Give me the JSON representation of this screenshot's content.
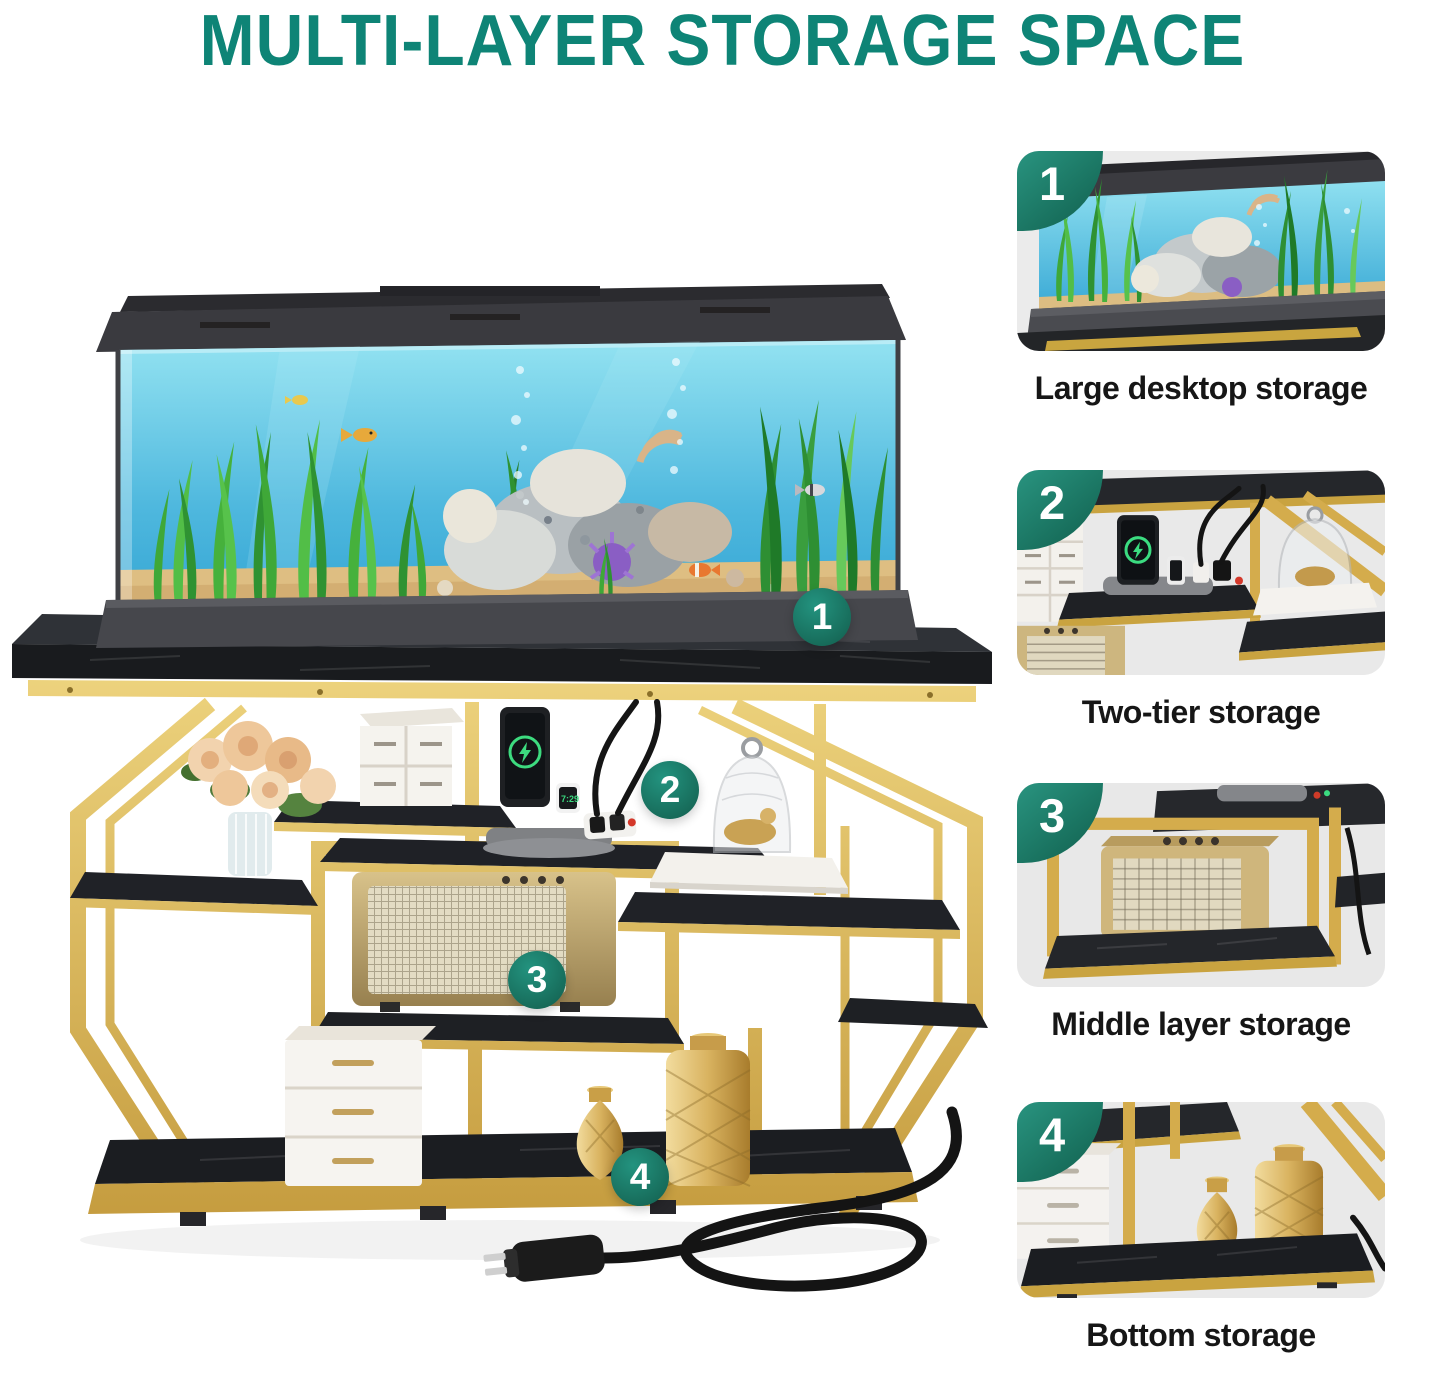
{
  "title": "MULTI-LAYER STORAGE SPACE",
  "colors": {
    "title_teal": "#0E8476",
    "badge_teal": "#1B7E6C",
    "gold": "#D4AA48",
    "marble_black": "#24262B",
    "thumb_background": "#EBEBEB"
  },
  "main_figure": {
    "watch_time": "7:29",
    "callouts": [
      {
        "number": "1"
      },
      {
        "number": "2"
      },
      {
        "number": "3"
      },
      {
        "number": "4"
      }
    ]
  },
  "features": [
    {
      "number": "1",
      "caption": "Large desktop storage"
    },
    {
      "number": "2",
      "caption": "Two-tier storage"
    },
    {
      "number": "3",
      "caption": "Middle layer storage"
    },
    {
      "number": "4",
      "caption": "Bottom storage"
    }
  ]
}
